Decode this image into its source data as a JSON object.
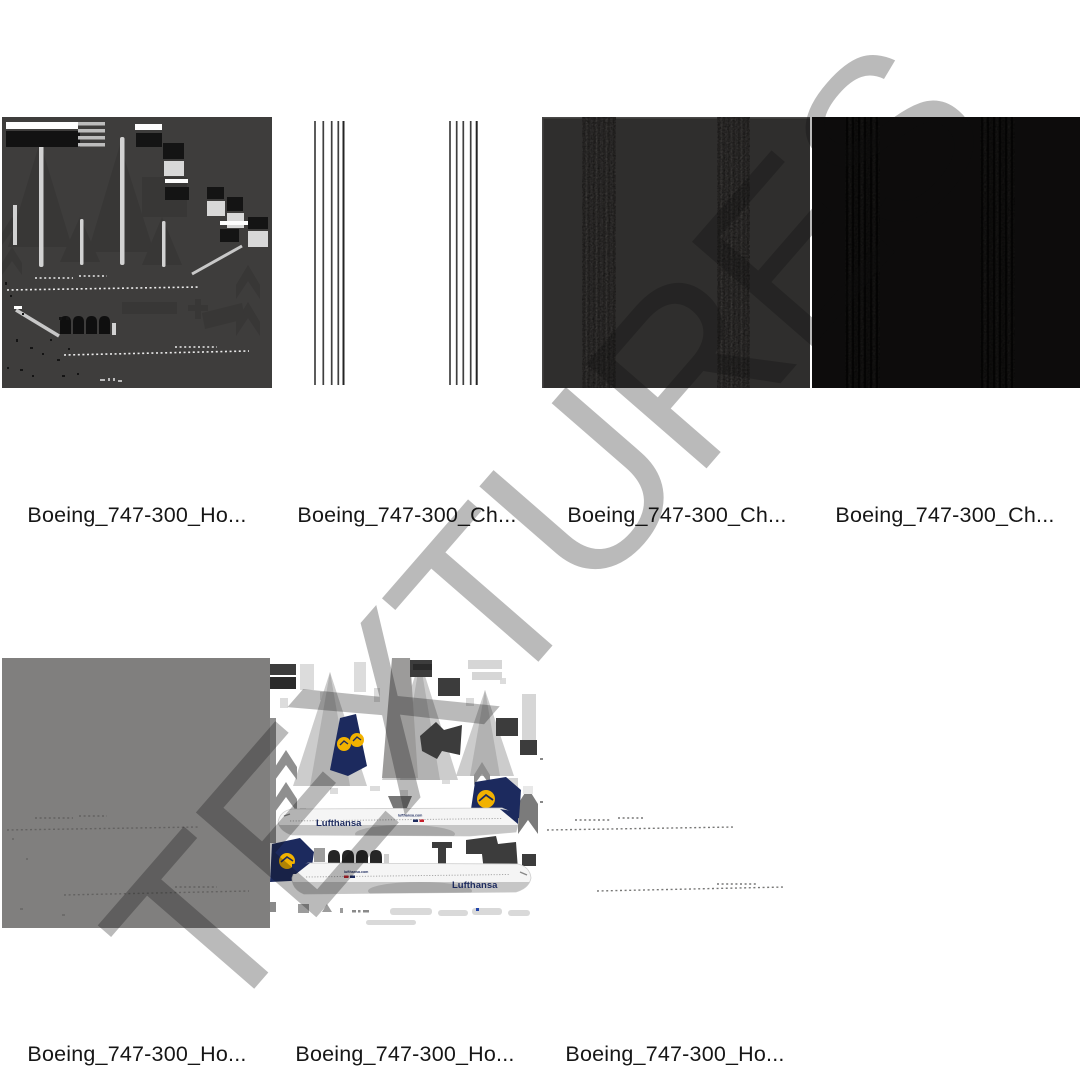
{
  "watermark": {
    "text": "TEXTURES",
    "color_over_white": "#bababa"
  },
  "gallery": {
    "rows": [
      {
        "items": [
          {
            "label": "Boeing_747-300_Ho...",
            "texture_kind": "dark-gray-uv-detail-map",
            "base_color": "#3e3d3c"
          },
          {
            "label": "Boeing_747-300_Ch...",
            "texture_kind": "white-vertical-line-groups",
            "base_color": "#ffffff"
          },
          {
            "label": "Boeing_747-300_Ch...",
            "texture_kind": "charcoal-vertical-band-map",
            "base_color": "#2f2e2d"
          },
          {
            "label": "Boeing_747-300_Ch...",
            "texture_kind": "black-vertical-band-map",
            "base_color": "#0d0c0c"
          }
        ]
      },
      {
        "items": [
          {
            "label": "Boeing_747-300_Ho...",
            "texture_kind": "medium-gray-window-row-map",
            "base_color": "#807f7e"
          },
          {
            "label": "Boeing_747-300_Ho...",
            "texture_kind": "lufthansa-livery-diffuse-map",
            "base_color": "#ffffff"
          },
          {
            "label": "Boeing_747-300_Ho...",
            "texture_kind": "white-window-row-map",
            "base_color": "#ffffff"
          }
        ]
      }
    ]
  },
  "livery": {
    "brand_wordmark": "Lufthansa",
    "url_wordmark": "lufthansa.com",
    "navy": "#1c2a5e",
    "yellow": "#f2b200",
    "red": "#c51f2a"
  }
}
